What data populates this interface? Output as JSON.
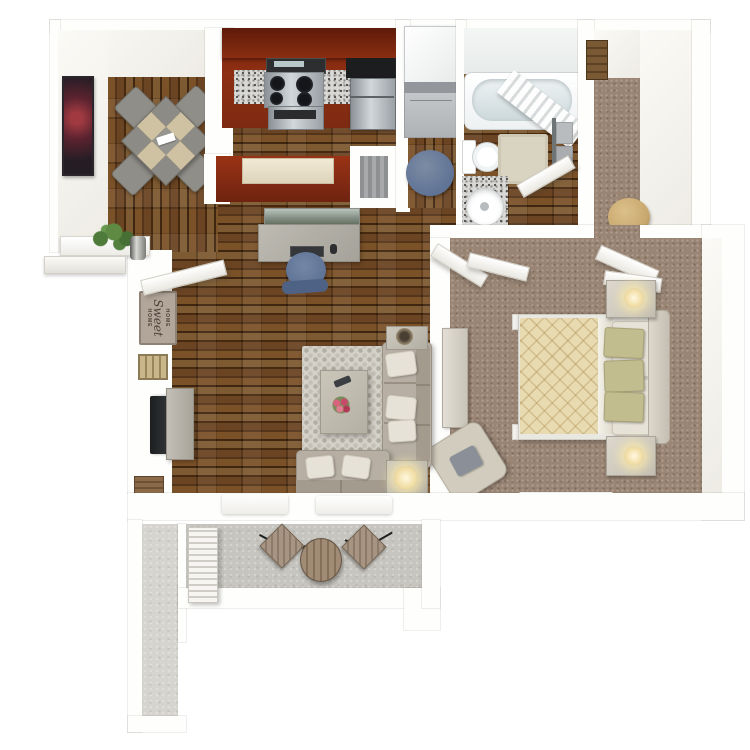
{
  "title": "One-bedroom apartment 3D floor plan rendering",
  "sign": {
    "line1": "HOME",
    "line2": "Sweet",
    "line3": "HOME"
  },
  "rooms": [
    {
      "id": "dining",
      "label": "Dining Area",
      "floor": "dark wood planks",
      "furniture": [
        "square table with gray-tan checkered top rotated 45deg",
        "4 gray chairs",
        "dark picture frame on west wall"
      ]
    },
    {
      "id": "kitchen",
      "label": "Kitchen",
      "floor": "rust-red cabinetry run",
      "furniture": [
        "dark red cabinets",
        "granite countertop",
        "gas range with oven",
        "black corner counter",
        "stainless refrigerator",
        "breakfast bar with cream top",
        "pantry niche"
      ]
    },
    {
      "id": "laundry",
      "label": "Laundry Closet",
      "floor": "wood",
      "furniture": [
        "stacked washer-dryer",
        "blue round stool"
      ]
    },
    {
      "id": "bathroom",
      "label": "Bathroom",
      "floor": "wood with granite tile at vanity",
      "furniture": [
        "bathtub",
        "diagonal shower curtain",
        "toilet",
        "beige bath mat",
        "round vanity sink",
        "towel rack with gray towels"
      ]
    },
    {
      "id": "hall",
      "label": "Entry Hall Closet",
      "floor": "brown carpet",
      "furniture": [
        "wood wall shelf",
        "tan hamper"
      ]
    },
    {
      "id": "bedroom",
      "label": "Bedroom",
      "floor": "brown carpet",
      "furniture": [
        "bed with cream quilted comforter",
        "white and sage pillows",
        "headboard",
        "2 nightstands with lit lamps",
        "sliding closet doors",
        "dresser",
        "beige armchair with gray pillow",
        "beach artwork",
        "white doormat"
      ]
    },
    {
      "id": "living",
      "label": "Living Room",
      "floor": "dark wood planks",
      "furniture": [
        "landscape artwork",
        "desk with monitor keyboard mouse",
        "blue desk chair",
        "pebble area rug",
        "coffee table with pink flowers and remote",
        "sectional sofa",
        "loveseat",
        "2 end tables",
        "decor bowl",
        "lit lamp",
        "wall TV",
        "media console",
        "Home Sweet Home sign",
        "key holder",
        "wood wall art",
        "plant on entry ledge",
        "2 white doormats",
        "open entry door"
      ]
    },
    {
      "id": "patio",
      "label": "Patio",
      "floor": "concrete",
      "furniture": [
        "round bistro table",
        "2 weathered bistro chairs",
        "louvered storage door",
        "narrow storage closet"
      ]
    }
  ],
  "palette": {
    "wall": "#fefefc",
    "wood": "#6a4524",
    "carpet": "#9a8574",
    "concrete": "#c7c5bf",
    "granite": "#d8d8d6",
    "rug": "#d4d1c9",
    "rugDot": "#b2aea3",
    "pillow": "#e7e2d7",
    "sage": "#c2bd8f",
    "kitchenRed": "#8e2f13",
    "kitchenRedDark": "#701f0c",
    "steelDark": "#7c8185",
    "black": "#1e1f21",
    "couch": "#b7afa4",
    "couchDark": "#a49b8f",
    "cream": "#e8dbb2",
    "creamLine": "#c7ab72",
    "blue": "#5f7396",
    "tan": "#c8a86e",
    "signBg": "#b2a69b",
    "plant": "#4e7a3a",
    "beachBlue": "#8fb2c4",
    "beachSand": "#d8cba6",
    "glowWarm": "#f7ecca"
  }
}
